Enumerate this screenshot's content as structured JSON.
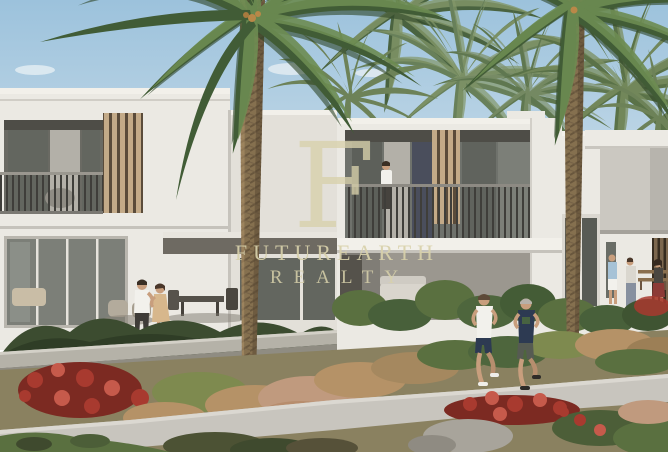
{
  "meta": {
    "type": "real-estate-listing-photo",
    "description": "Architectural rendering of a row of modern two-storey white townhouses with recessed balconies, wooden slat screens, tall palm trees, landscaped flower beds, a walking path with two joggers, a couple on a patio and residents near a bench"
  },
  "watermark": {
    "monogram": "F",
    "title": "FUTUREARTH",
    "subtitle": "REALTY",
    "color": "#d8d1ab"
  },
  "colors": {
    "sky_top": "#9cc2dc",
    "sky_bottom": "#d6e4ed",
    "cloud": "#eef3f6",
    "wall_white": "#ebe9e3",
    "wall_lit2": "#e3e0d9",
    "wall_shade": "#d8d5ce",
    "fascia": "#f2f0ea",
    "soffit": "#4e4d47",
    "glass_dark": "#63665f",
    "glass_mid": "#7c7f78",
    "curtain": "#b3b0a8",
    "slat_light": "#c3aa88",
    "slat_gap": "#5a4b3a",
    "slat_dark_panel": "#7c674e",
    "railing": "#3f3e3a",
    "beam_shadow": "#6e6a62",
    "terrace_shade": "#9b978f",
    "palm_green": "#415c36",
    "palm_green_light": "#6d8c52",
    "palm_green_bg": "#68805a",
    "palm_green_bg_light": "#84986a",
    "trunk": "#85704f",
    "trunk_dark": "#52422f",
    "trunk_light": "#b3956c",
    "hedge": "#3c4c30",
    "shrub": "#5a7040",
    "shrub_yellow": "#7e8a4f",
    "dry_grass": "#b59267",
    "dry_pink": "#c09a7e",
    "flower_red": "#a83a2f",
    "flower_red_bright": "#c65a4b",
    "flower_red_deep": "#7c2a22",
    "path": "#c8c5be",
    "ground": "#8a8160",
    "stone": "#a8a49b",
    "wall_gray": "#b5b2a8",
    "watermark": "#d8d1ab",
    "skin": "#c89e7d",
    "navy": "#2d3a52",
    "white_cloth": "#f2f1ec",
    "tan_dress": "#d7b78c",
    "shorts_gray": "#565b52",
    "light_blue": "#a6c2d6",
    "jeans": "#87909f"
  }
}
